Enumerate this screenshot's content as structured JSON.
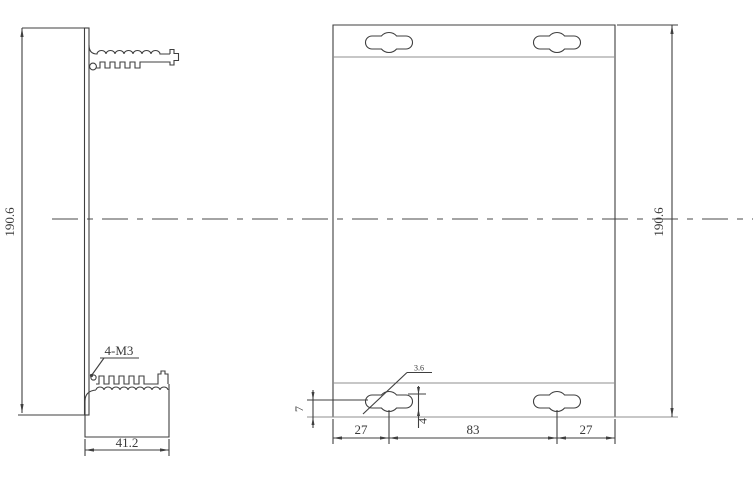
{
  "drawing_type": "engineering-dimension-drawing",
  "views": {
    "side_view": {
      "height_label": "190.6",
      "depth_label": "41.2",
      "hole_callout": "4-M3"
    },
    "front_view": {
      "height_label": "190.6",
      "slot_callout": "3.6",
      "slot_center_offset_label": "7",
      "slot_width_label": "4",
      "bottom_left_span_label": "27",
      "bottom_center_span_label": "83",
      "bottom_right_span_label": "27"
    }
  },
  "colors": {
    "background": "#ffffff",
    "main_line": "#3f3f3f",
    "light_line": "#8f8f8f",
    "text": "#3a3a3a"
  }
}
